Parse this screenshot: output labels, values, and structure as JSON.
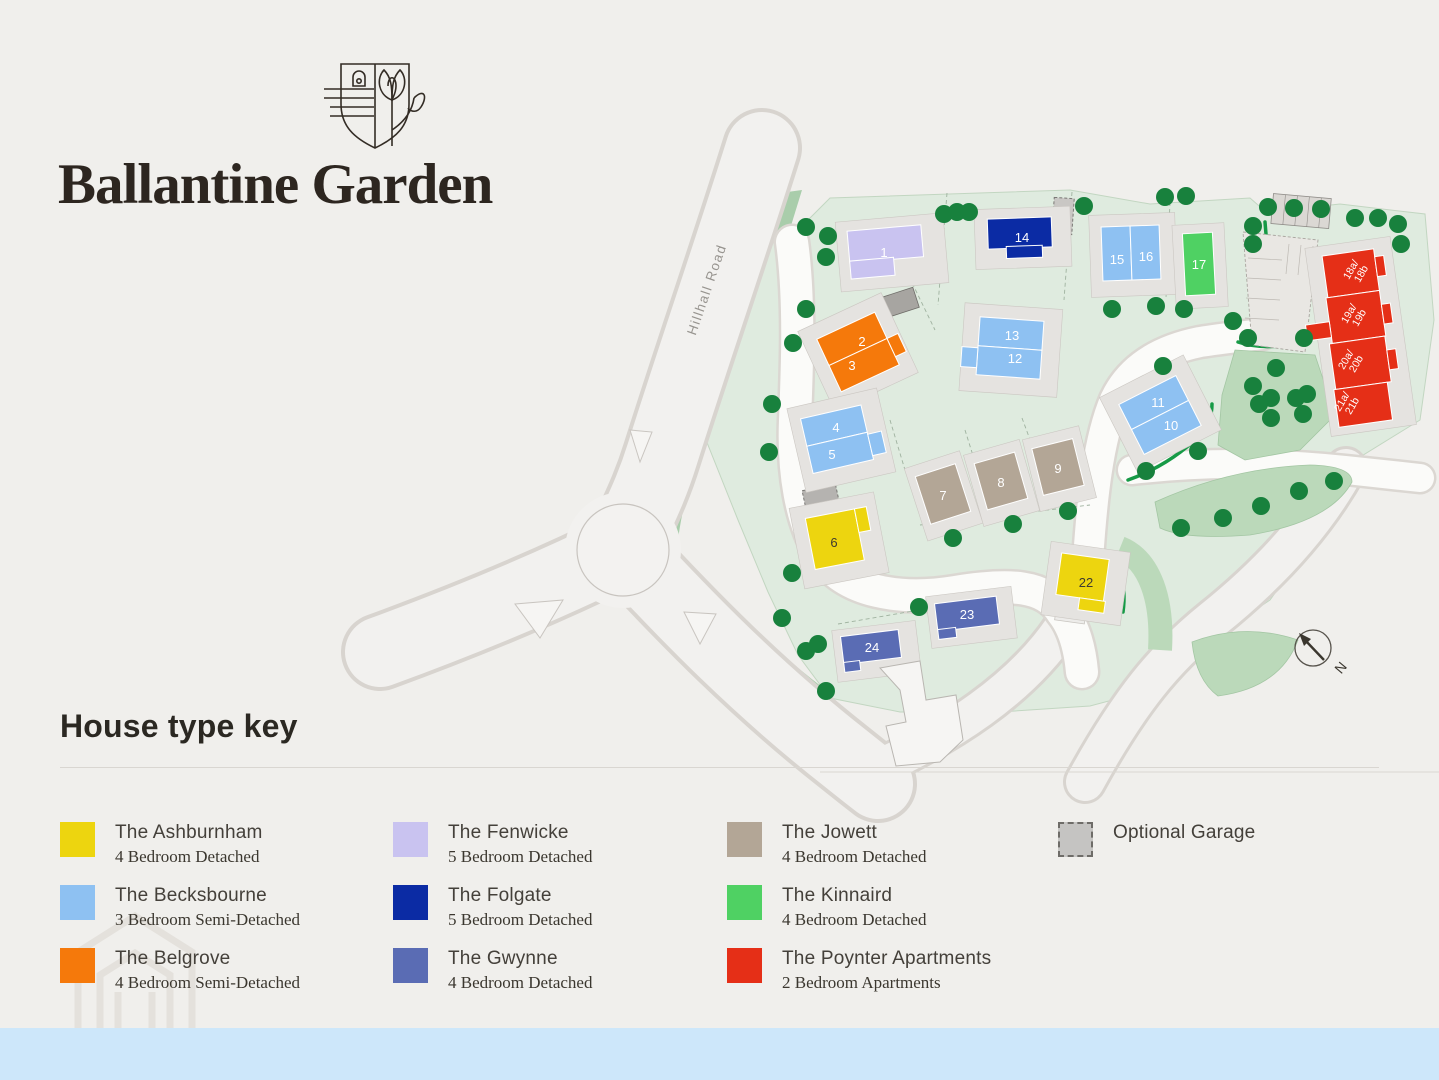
{
  "brand": {
    "title": "Ballantine Garden"
  },
  "map": {
    "road_label": "Hillhall Road",
    "north_label": "N",
    "house_colors": {
      "ashburnham": "#EDD50F",
      "becksbourne": "#8EC1F2",
      "belgrove": "#F5790B",
      "fenwicke": "#C9C3F0",
      "folgate": "#0B2BA4",
      "gwynne": "#5A6CB4",
      "jowett": "#B3A696",
      "kinnaird": "#4FD163",
      "poynter": "#E52F17",
      "garage": "#C5C4C2"
    },
    "plot_labels": {
      "p1": "1",
      "p2": "2",
      "p3": "3",
      "p4": "4",
      "p5": "5",
      "p6": "6",
      "p7": "7",
      "p8": "8",
      "p9": "9",
      "p10": "10",
      "p11": "11",
      "p12": "12",
      "p13": "13",
      "p14": "14",
      "p15": "15",
      "p16": "16",
      "p17": "17",
      "p18a": "18a/",
      "p18b": "18b",
      "p19a": "19a/",
      "p19b": "19b",
      "p20a": "20a/",
      "p20b": "20b",
      "p21a": "21a/",
      "p21b": "21b",
      "p22": "22",
      "p23": "23",
      "p24": "24"
    }
  },
  "legend": {
    "heading": "House type key",
    "items": [
      {
        "name": "The Ashburnham",
        "desc": "4 Bedroom Detached",
        "swatch": "background:#EDD50F"
      },
      {
        "name": "The Becksbourne",
        "desc": "3 Bedroom Semi-Detached",
        "swatch": "background:#8EC1F2"
      },
      {
        "name": "The Belgrove",
        "desc": "4 Bedroom Semi-Detached",
        "swatch": "background:#F5790B"
      },
      {
        "name": "The Fenwicke",
        "desc": "5 Bedroom Detached",
        "swatch": "background:#C9C3F0"
      },
      {
        "name": "The Folgate",
        "desc": "5 Bedroom Detached",
        "swatch": "background:#0B2BA4"
      },
      {
        "name": "The Gwynne",
        "desc": "4 Bedroom Detached",
        "swatch": "background:#5A6CB4"
      },
      {
        "name": "The Jowett",
        "desc": "4 Bedroom Detached",
        "swatch": "background:#B3A696"
      },
      {
        "name": "The Kinnaird",
        "desc": "4 Bedroom Detached",
        "swatch": "background:#4FD163"
      },
      {
        "name": "The Poynter Apartments",
        "desc": "2 Bedroom Apartments",
        "swatch": "background:#E52F17"
      },
      {
        "name": "Optional Garage",
        "desc": "",
        "swatch": "background:#C5C4C2;border:2px dashed #6E6C68;width:31px;height:31px"
      }
    ]
  }
}
